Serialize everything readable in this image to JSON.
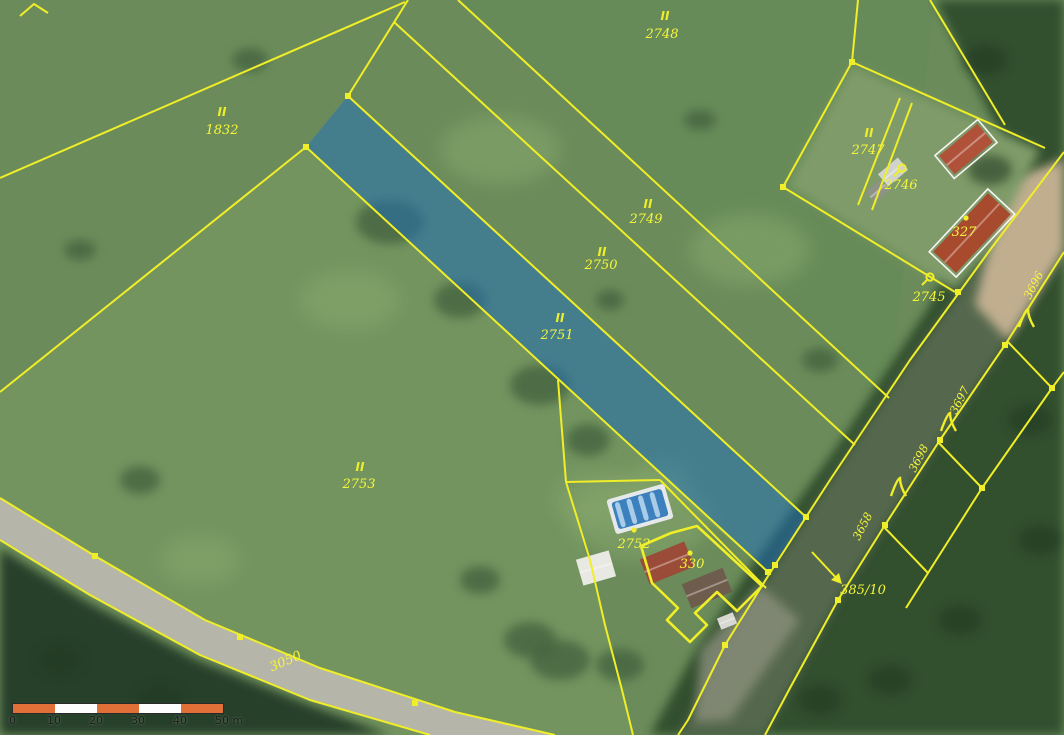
{
  "map": {
    "colors": {
      "field_base": "#6b8c5a",
      "field_light": "#7a9a64",
      "field_tint": "#648a55",
      "forest": "#31502f",
      "forest_dark": "#27402a",
      "road_corridor": "#55674d",
      "road_surface_tan": "#c0ae8f",
      "asphalt": "#b5b5a9",
      "cadastral_yellow": "#f0ee28",
      "label_yellow": "#f6f63a",
      "highlight_blue": "#1d6fc0",
      "highlight_opacity": 0.5,
      "building_white": "#f5f5f2",
      "scale_orange": "#e07038",
      "scale_white": "#fdfdfd"
    },
    "parcel_labels": [
      {
        "t": "2748",
        "x": 662,
        "y": 38
      },
      {
        "t": "1832",
        "x": 222,
        "y": 134
      },
      {
        "t": "2749",
        "x": 646,
        "y": 223
      },
      {
        "t": "2750",
        "x": 601,
        "y": 269
      },
      {
        "t": "2751",
        "x": 557,
        "y": 339
      },
      {
        "t": "2747",
        "x": 868,
        "y": 154
      },
      {
        "t": "2746",
        "x": 901,
        "y": 189
      },
      {
        "t": "2745",
        "x": 929,
        "y": 301
      },
      {
        "t": "327",
        "x": 964,
        "y": 236
      },
      {
        "t": "2753",
        "x": 359,
        "y": 488
      },
      {
        "t": "2752",
        "x": 634,
        "y": 548
      },
      {
        "t": "330",
        "x": 692,
        "y": 568
      },
      {
        "t": "3050",
        "x": 287,
        "y": 665,
        "r": -23
      },
      {
        "t": "385/10",
        "x": 863,
        "y": 594
      },
      {
        "t": "3696",
        "x": 1037,
        "y": 287,
        "r": -63,
        "small": true
      },
      {
        "t": "3697",
        "x": 963,
        "y": 402,
        "r": -63,
        "small": true
      },
      {
        "t": "3698",
        "x": 922,
        "y": 460,
        "r": -63,
        "small": true
      },
      {
        "t": "3658",
        "x": 866,
        "y": 528,
        "r": -63,
        "small": true
      }
    ],
    "grass_symbols": [
      [
        665,
        20
      ],
      [
        222,
        116
      ],
      [
        648,
        208
      ],
      [
        602,
        256
      ],
      [
        560,
        322
      ],
      [
        869,
        137
      ],
      [
        360,
        471
      ]
    ],
    "tree_symbols": [
      [
        1026,
        318
      ],
      [
        948,
        422
      ],
      [
        898,
        487
      ]
    ],
    "landuse_symbols": [
      [
        902,
        168
      ],
      [
        930,
        277
      ]
    ],
    "point_symbols": [
      [
        966,
        218
      ],
      [
        690,
        553
      ],
      [
        634,
        530
      ]
    ],
    "boundary_lines": [
      {
        "pts": [
          [
            408,
            0
          ],
          [
            348,
            96
          ]
        ]
      },
      {
        "pts": [
          [
            306,
            147
          ],
          [
            0,
            392
          ]
        ]
      },
      {
        "pts": [
          [
            0,
            178
          ],
          [
            405,
            2
          ]
        ]
      },
      {
        "pts": [
          [
            458,
            0
          ],
          [
            889,
            398
          ]
        ]
      },
      {
        "pts": [
          [
            394,
            22
          ],
          [
            855,
            445
          ]
        ]
      },
      {
        "pts": [
          [
            348,
            96
          ],
          [
            806,
            517
          ]
        ]
      },
      {
        "pts": [
          [
            306,
            147
          ],
          [
            768,
            572
          ]
        ]
      },
      {
        "pts": [
          [
            20,
            16
          ],
          [
            34,
            4
          ],
          [
            48,
            13
          ]
        ]
      },
      {
        "pts": [
          [
            858,
            0
          ],
          [
            852,
            62
          ]
        ]
      },
      {
        "pts": [
          [
            852,
            62
          ],
          [
            783,
            187
          ]
        ]
      },
      {
        "pts": [
          [
            783,
            187
          ],
          [
            955,
            292
          ]
        ]
      },
      {
        "pts": [
          [
            852,
            62
          ],
          [
            1045,
            148
          ]
        ]
      },
      {
        "pts": [
          [
            930,
            0
          ],
          [
            1005,
            125
          ]
        ]
      },
      {
        "pts": [
          [
            858,
            205
          ],
          [
            900,
            98
          ]
        ]
      },
      {
        "pts": [
          [
            872,
            210
          ],
          [
            912,
            103
          ]
        ]
      },
      {
        "pts": [
          [
            1064,
            152
          ],
          [
            990,
            250
          ],
          [
            910,
            360
          ],
          [
            830,
            480
          ],
          [
            775,
            565
          ],
          [
            725,
            645
          ],
          [
            688,
            720
          ],
          [
            678,
            735
          ]
        ]
      },
      {
        "pts": [
          [
            1064,
            252
          ],
          [
            1005,
            345
          ],
          [
            940,
            440
          ],
          [
            885,
            525
          ],
          [
            838,
            600
          ],
          [
            790,
            688
          ],
          [
            765,
            735
          ]
        ]
      },
      {
        "pts": [
          [
            1064,
            372
          ],
          [
            1052,
            388
          ],
          [
            982,
            488
          ],
          [
            928,
            573
          ],
          [
            906,
            608
          ]
        ]
      },
      {
        "pts": [
          [
            1008,
            342
          ],
          [
            1052,
            388
          ]
        ]
      },
      {
        "pts": [
          [
            938,
            442
          ],
          [
            982,
            488
          ]
        ]
      },
      {
        "pts": [
          [
            884,
            527
          ],
          [
            928,
            573
          ]
        ]
      },
      {
        "pts": [
          [
            0,
            498
          ],
          [
            95,
            556
          ],
          [
            205,
            620
          ],
          [
            320,
            668
          ],
          [
            455,
            712
          ],
          [
            555,
            735
          ]
        ]
      },
      {
        "pts": [
          [
            0,
            540
          ],
          [
            90,
            595
          ],
          [
            200,
            655
          ],
          [
            310,
            700
          ],
          [
            430,
            735
          ]
        ]
      },
      {
        "pts": [
          [
            558,
            380
          ],
          [
            566,
            482
          ]
        ]
      },
      {
        "pts": [
          [
            566,
            482
          ],
          [
            590,
            560
          ],
          [
            605,
            625
          ],
          [
            622,
            690
          ],
          [
            633,
            735
          ]
        ]
      },
      {
        "pts": [
          [
            566,
            482
          ],
          [
            660,
            480
          ]
        ]
      },
      {
        "pts": [
          [
            660,
            480
          ],
          [
            766,
            588
          ]
        ]
      },
      {
        "pts": [
          [
            641,
            546
          ],
          [
            671,
            533
          ],
          [
            697,
            526
          ],
          [
            762,
            586
          ],
          [
            737,
            611
          ],
          [
            717,
            592
          ],
          [
            695,
            613
          ],
          [
            707,
            625
          ],
          [
            690,
            642
          ],
          [
            667,
            620
          ],
          [
            678,
            608
          ],
          [
            652,
            583
          ],
          [
            641,
            546
          ]
        ],
        "w": 2.6
      }
    ],
    "vertex_dots": [
      [
        348,
        96
      ],
      [
        306,
        147
      ],
      [
        806,
        517
      ],
      [
        768,
        572
      ],
      [
        775,
        565
      ],
      [
        725,
        645
      ],
      [
        1005,
        345
      ],
      [
        940,
        440
      ],
      [
        885,
        525
      ],
      [
        838,
        600
      ],
      [
        95,
        556
      ],
      [
        240,
        637
      ],
      [
        415,
        703
      ],
      [
        852,
        62
      ],
      [
        783,
        187
      ],
      [
        958,
        292
      ],
      [
        1052,
        388
      ],
      [
        982,
        488
      ]
    ],
    "blue_parcel": [
      [
        348,
        96
      ],
      [
        306,
        147
      ],
      [
        768,
        572
      ],
      [
        806,
        517
      ]
    ],
    "areas": {
      "forest_east": [
        [
          935,
          0
        ],
        [
          1064,
          0
        ],
        [
          1064,
          735
        ],
        [
          650,
          735
        ],
        [
          693,
          655
        ],
        [
          752,
          565
        ],
        [
          838,
          445
        ],
        [
          930,
          305
        ],
        [
          1000,
          135
        ]
      ],
      "forest_bottom_left": [
        [
          0,
          548
        ],
        [
          88,
          602
        ],
        [
          198,
          660
        ],
        [
          308,
          704
        ],
        [
          390,
          735
        ],
        [
          0,
          735
        ]
      ],
      "road_corridor": [
        [
          1064,
          152
        ],
        [
          990,
          250
        ],
        [
          910,
          360
        ],
        [
          830,
          480
        ],
        [
          775,
          565
        ],
        [
          725,
          645
        ],
        [
          688,
          720
        ],
        [
          678,
          735
        ],
        [
          765,
          735
        ],
        [
          790,
          688
        ],
        [
          838,
          600
        ],
        [
          885,
          525
        ],
        [
          940,
          440
        ],
        [
          1005,
          345
        ],
        [
          1064,
          252
        ]
      ],
      "road_tan_patch": [
        [
          1005,
          180
        ],
        [
          1064,
          160
        ],
        [
          1064,
          250
        ],
        [
          1008,
          340
        ],
        [
          975,
          305
        ]
      ],
      "road_bottom_patch": [
        [
          700,
          650
        ],
        [
          760,
          585
        ],
        [
          800,
          620
        ],
        [
          730,
          720
        ],
        [
          695,
          722
        ]
      ],
      "asphalt": [
        [
          0,
          498
        ],
        [
          95,
          556
        ],
        [
          205,
          620
        ],
        [
          320,
          668
        ],
        [
          455,
          712
        ],
        [
          555,
          735
        ],
        [
          430,
          735
        ],
        [
          310,
          700
        ],
        [
          200,
          655
        ],
        [
          90,
          595
        ],
        [
          0,
          540
        ]
      ],
      "farmyard": [
        [
          852,
          66
        ],
        [
          1040,
          150
        ],
        [
          988,
          252
        ],
        [
          955,
          290
        ],
        [
          788,
          186
        ]
      ],
      "field_2753": [
        [
          0,
          392
        ],
        [
          306,
          147
        ],
        [
          768,
          572
        ],
        [
          660,
          480
        ],
        [
          566,
          482
        ],
        [
          605,
          625
        ],
        [
          633,
          735
        ],
        [
          0,
          735
        ]
      ]
    },
    "dark_blobs": [
      [
        390,
        222,
        34,
        22
      ],
      [
        460,
        300,
        26,
        18
      ],
      [
        540,
        385,
        30,
        20
      ],
      [
        588,
        440,
        22,
        16
      ],
      [
        610,
        300,
        14,
        10
      ],
      [
        700,
        120,
        16,
        10
      ],
      [
        250,
        60,
        18,
        12
      ],
      [
        140,
        480,
        20,
        14
      ],
      [
        80,
        250,
        16,
        10
      ],
      [
        820,
        360,
        18,
        12
      ],
      [
        530,
        640,
        26,
        18
      ],
      [
        480,
        580,
        20,
        14
      ],
      [
        560,
        660,
        30,
        20
      ],
      [
        620,
        665,
        24,
        16
      ]
    ],
    "light_blobs": [
      [
        600,
        500,
        46,
        28
      ],
      [
        660,
        482,
        30,
        20
      ],
      [
        200,
        560,
        40,
        24
      ],
      [
        350,
        300,
        50,
        30
      ],
      [
        750,
        250,
        60,
        36
      ],
      [
        500,
        150,
        60,
        34
      ],
      [
        640,
        520,
        70,
        40
      ]
    ],
    "buildings": [
      {
        "cx": 966,
        "cy": 149,
        "w": 50,
        "h": 24,
        "rot": -40,
        "roof": "#b0513a",
        "outline": true
      },
      {
        "cx": 972,
        "cy": 233,
        "w": 80,
        "h": 31,
        "rot": -47,
        "roof": "#a84a2e",
        "outline": true
      },
      {
        "cx": 893,
        "cy": 172,
        "w": 26,
        "h": 16,
        "rot": -40,
        "roof": "#cfd3cc",
        "outline": false
      },
      {
        "cx": 878,
        "cy": 191,
        "w": 20,
        "h": 14,
        "rot": -40,
        "roof": "#8e9287",
        "outline": false
      },
      {
        "cx": 667,
        "cy": 563,
        "w": 48,
        "h": 27,
        "rot": -22,
        "roof": "#9a4c38",
        "outline": false
      },
      {
        "cx": 707,
        "cy": 588,
        "w": 44,
        "h": 26,
        "rot": -22,
        "roof": "#6e5c4c",
        "outline": false
      },
      {
        "cx": 596,
        "cy": 568,
        "w": 34,
        "h": 27,
        "rot": -16,
        "roof": "#e9e9e3",
        "outline": false
      },
      {
        "cx": 727,
        "cy": 621,
        "w": 17,
        "h": 12,
        "rot": -22,
        "roof": "#d8d8d2",
        "outline": false
      }
    ],
    "pool": {
      "cx": 640,
      "cy": 509,
      "w": 60,
      "h": 36,
      "rot": -16,
      "deck": "#e6e9ea",
      "water": "#3c80bd",
      "lanes": "#a9cde8"
    },
    "arrow_385_10": {
      "line": [
        [
          812,
          552
        ],
        [
          840,
          582
        ]
      ],
      "head": [
        [
          842,
          584
        ],
        [
          831,
          580
        ],
        [
          839,
          573
        ]
      ]
    },
    "scale_bar": {
      "ticks": [
        "0",
        "10",
        "20",
        "30",
        "40",
        "50 m"
      ],
      "segments": [
        "orange",
        "white",
        "orange",
        "white",
        "orange"
      ],
      "segment_px": 42
    }
  }
}
